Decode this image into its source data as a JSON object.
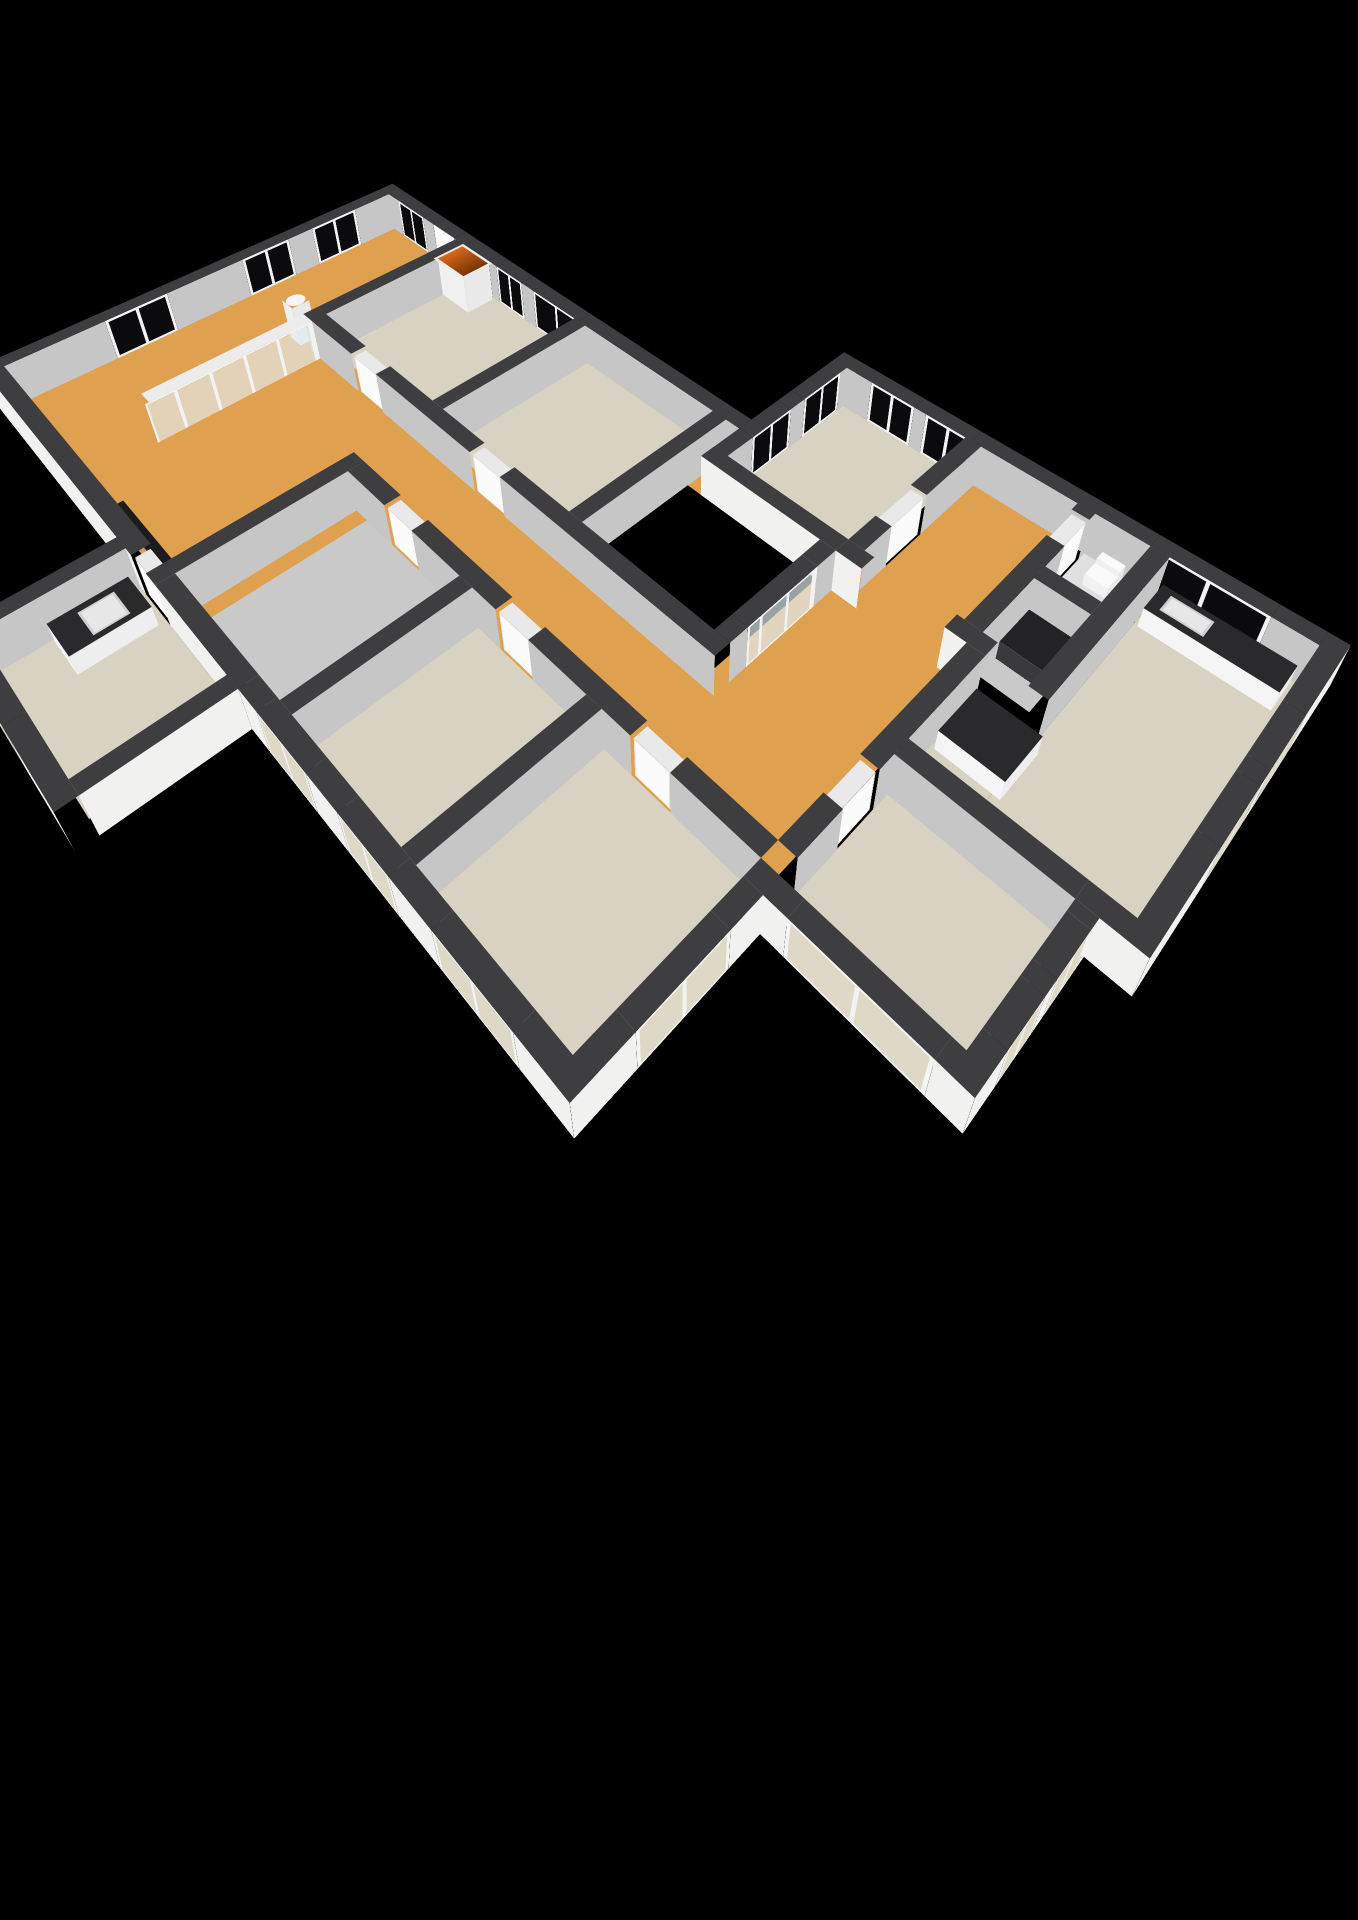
{
  "title": "3D floor plan rendering",
  "view": {
    "type": "isometric-3d",
    "background": "#000000",
    "labels_visible": false
  },
  "colors": {
    "bg": "#000000",
    "floor_orange": "#dfa050",
    "floor_beige": "#d8d2c2",
    "floor_gray": "#c9c9c9",
    "floor_light": "#e0e0e0",
    "wall_cap": "#3e3e40",
    "wall_int": "#c6c6c6",
    "wall_ext": "#f1f1ef",
    "glass_black": "#0b0b0d",
    "glass_light": "#ded8c6",
    "counter_dark": "#2a2a2c"
  },
  "rooms": [
    {
      "name": "living-room",
      "floor": "orange"
    },
    {
      "name": "hallway",
      "floor": "orange"
    },
    {
      "name": "corridor-link",
      "floor": "orange"
    },
    {
      "name": "bedroom-top-right",
      "floor": "beige"
    },
    {
      "name": "hall-right-wing",
      "floor": "orange"
    },
    {
      "name": "toilet-room",
      "floor": "light-gray"
    },
    {
      "name": "utility-room",
      "floor": "gray"
    },
    {
      "name": "kitchen",
      "floor": "beige"
    },
    {
      "name": "bedroom-north-west",
      "floor": "beige"
    },
    {
      "name": "bedroom-north-middle",
      "floor": "beige"
    },
    {
      "name": "bedroom-south-1",
      "floor": "gray"
    },
    {
      "name": "bedroom-south-2",
      "floor": "beige"
    },
    {
      "name": "bedroom-south-3",
      "floor": "beige"
    },
    {
      "name": "bedroom-east",
      "floor": "beige"
    },
    {
      "name": "bathroom",
      "floor": "beige"
    },
    {
      "name": "void-courtyard",
      "floor": "black"
    }
  ],
  "fixtures": [
    {
      "name": "kitchen-counter-with-sink"
    },
    {
      "name": "kitchen-island-counter"
    },
    {
      "name": "toilet-fixture"
    },
    {
      "name": "utility-appliance"
    },
    {
      "name": "bathroom-counter-with-basin"
    },
    {
      "name": "fireplace"
    },
    {
      "name": "column"
    },
    {
      "name": "glass-partition"
    },
    {
      "name": "doormat-recess"
    }
  ]
}
